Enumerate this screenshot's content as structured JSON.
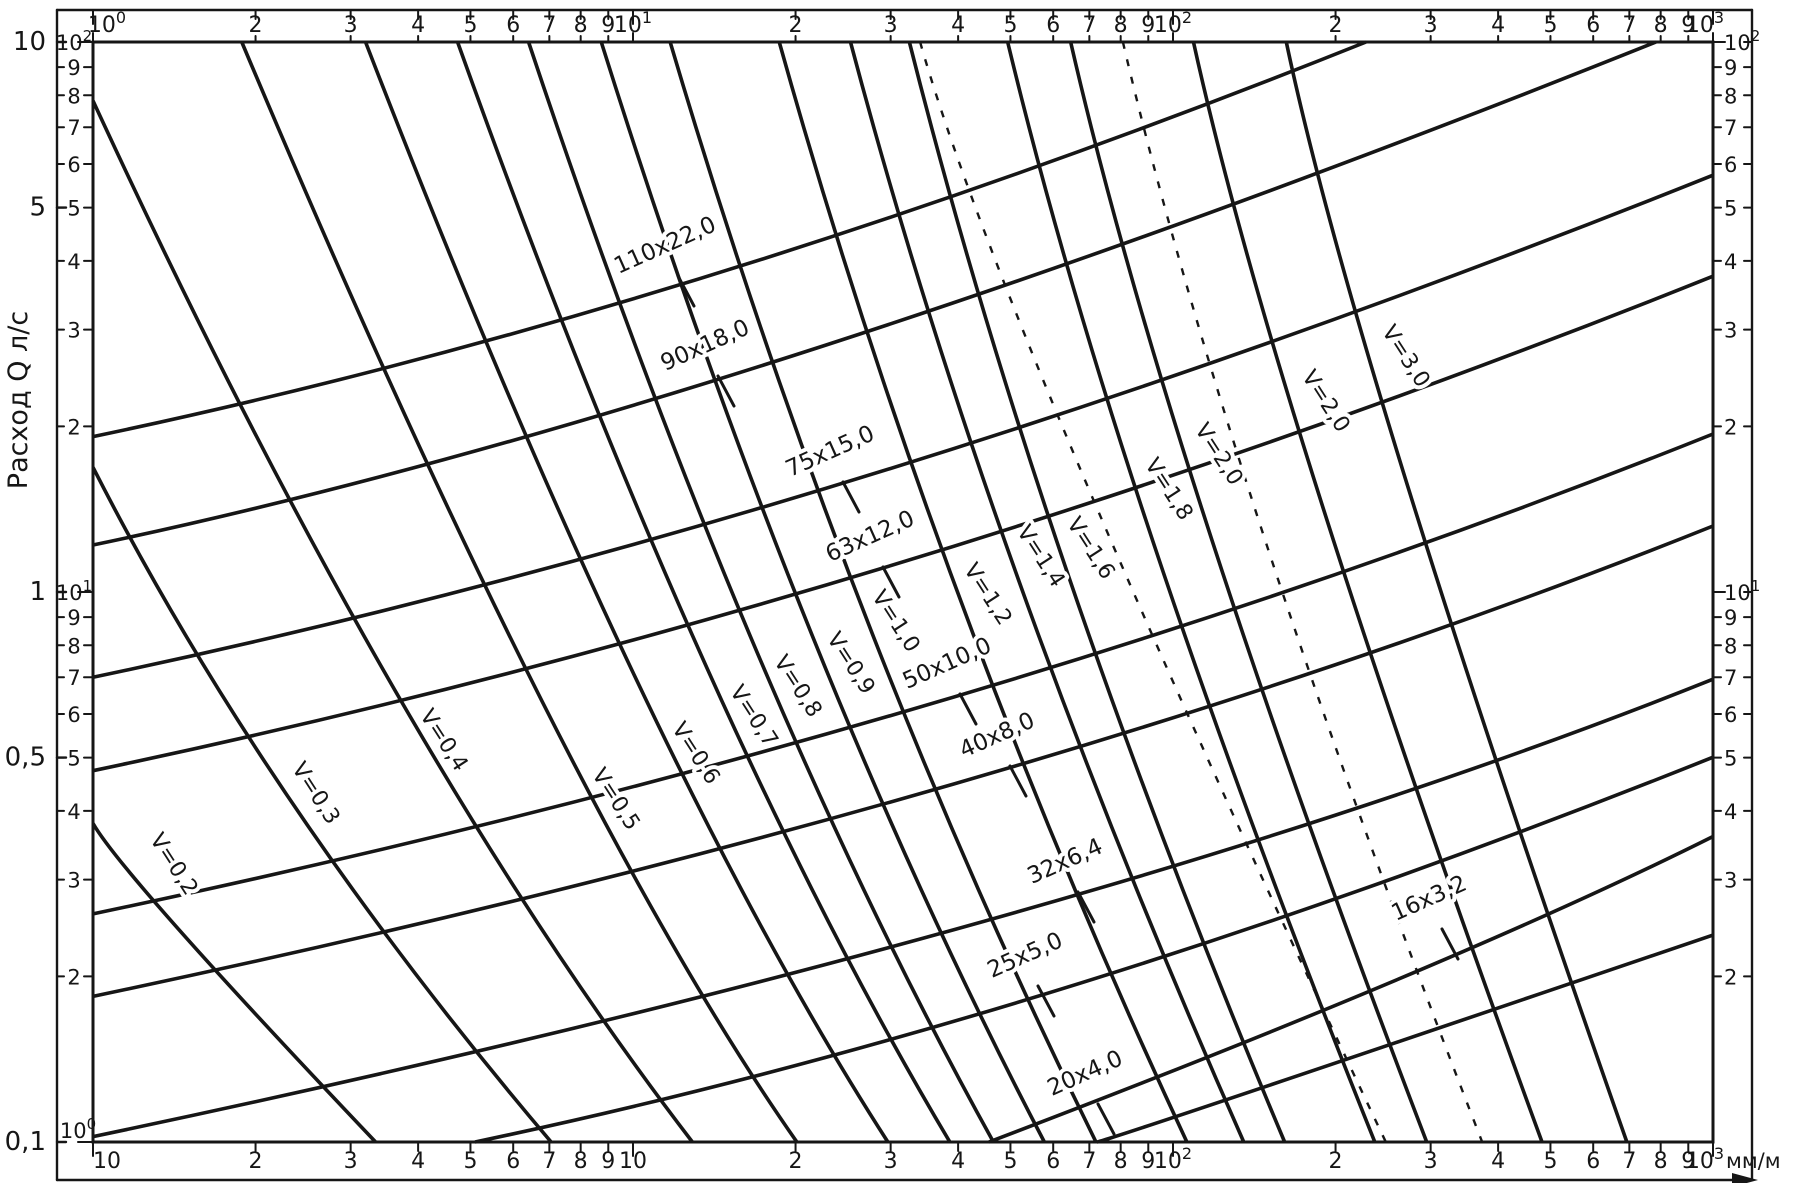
{
  "chart_data": {
    "type": "nomogram-loglog",
    "description": "Hydraulic nomogram: flow rate vs hydraulic gradient for plastic pipes, with pipe-size lines (OD x wall, mm) ascending and constant-velocity lines (m/s) descending",
    "x_axis": {
      "scale": "log",
      "range": [
        1,
        1000
      ],
      "unit": "мм/м",
      "decade_labels_top": [
        "10^0",
        "10^1",
        "10^2",
        "10^3"
      ],
      "decade_labels_bottom": [
        "10",
        "10",
        "10^2",
        "10^3"
      ],
      "minor_tick_labels": [
        "2",
        "3",
        "4",
        "5",
        "6",
        "7",
        "8",
        "9"
      ]
    },
    "y_axis": {
      "scale": "log",
      "title": "Расход Q л/с",
      "range_inner": [
        1,
        100
      ],
      "decade_labels_left": [
        "10^2",
        "10^1",
        "10^0"
      ],
      "decade_labels_right": [
        "10^2",
        "10^1"
      ],
      "minor_tick_labels": [
        "9",
        "8",
        "7",
        "6",
        "5",
        "4",
        "3",
        "2"
      ],
      "outer_flow_labels": [
        {
          "text": "10",
          "value": 100
        },
        {
          "text": "5",
          "value": 50
        },
        {
          "text": "1",
          "value": 10
        },
        {
          "text": "0,5",
          "value": 5
        },
        {
          "text": "0,1",
          "value": 1
        }
      ]
    },
    "pipe_lines": [
      {
        "label": "110x22,0",
        "x": 668,
        "y": 252
      },
      {
        "label": "90x18,0",
        "x": 708,
        "y": 352
      },
      {
        "label": "75x15,0",
        "x": 833,
        "y": 458
      },
      {
        "label": "63x12,0",
        "x": 873,
        "y": 543
      },
      {
        "label": "50x10,0",
        "x": 950,
        "y": 670
      },
      {
        "label": "40x8,0",
        "x": 1000,
        "y": 742
      },
      {
        "label": "32x6,4",
        "x": 1068,
        "y": 868
      },
      {
        "label": "25x5,0",
        "x": 1028,
        "y": 962
      },
      {
        "label": "20x4,0",
        "x": 1088,
        "y": 1080,
        "sr": 0.34
      },
      {
        "label": "16x3,2",
        "x": 1432,
        "y": 905,
        "sl": 0.38,
        "sr": 0.5
      }
    ],
    "velocity_lines": [
      {
        "label": "V=0,2",
        "x": 168,
        "y": 868,
        "slope": 1.35
      },
      {
        "label": "V=0,3",
        "x": 310,
        "y": 797,
        "slope": 1.51
      },
      {
        "label": "V=0,4",
        "x": 438,
        "y": 744,
        "slope": 1.67
      },
      {
        "label": "V=0,5",
        "x": 610,
        "y": 803,
        "slope": 1.83
      },
      {
        "label": "V=0,6",
        "x": 690,
        "y": 757,
        "slope": 1.99
      },
      {
        "label": "V=0,7",
        "x": 748,
        "y": 720,
        "slope": 2.15
      },
      {
        "label": "V=0,8",
        "x": 792,
        "y": 690,
        "slope": 2.31
      },
      {
        "label": "V=0,9",
        "x": 845,
        "y": 667,
        "slope": 2.45
      },
      {
        "label": "V=1,0",
        "x": 890,
        "y": 625,
        "slope": 2.6
      },
      {
        "label": "V=1,2",
        "x": 982,
        "y": 598,
        "slope": 2.75
      },
      {
        "label": "V=1,4",
        "x": 1035,
        "y": 560,
        "slope": 2.9
      },
      {
        "label": "V=1,6",
        "x": 1085,
        "y": 552,
        "slope": 3.05
      },
      {
        "label": "V=1,8",
        "x": 1163,
        "y": 493,
        "slope": 3.2
      },
      {
        "label": "V=2,0",
        "x": 1213,
        "y": 458,
        "slope": 3.35
      },
      {
        "label": "V=2,0",
        "x": 1320,
        "y": 405,
        "slope": 3.5
      },
      {
        "label": "V=3,0",
        "x": 1400,
        "y": 360,
        "slope": 3.65
      }
    ],
    "dashed_lines": [
      {
        "x": 1005,
        "y": 340,
        "slope": 2.7
      },
      {
        "x": 1225,
        "y": 480,
        "slope": 3.3
      }
    ]
  }
}
